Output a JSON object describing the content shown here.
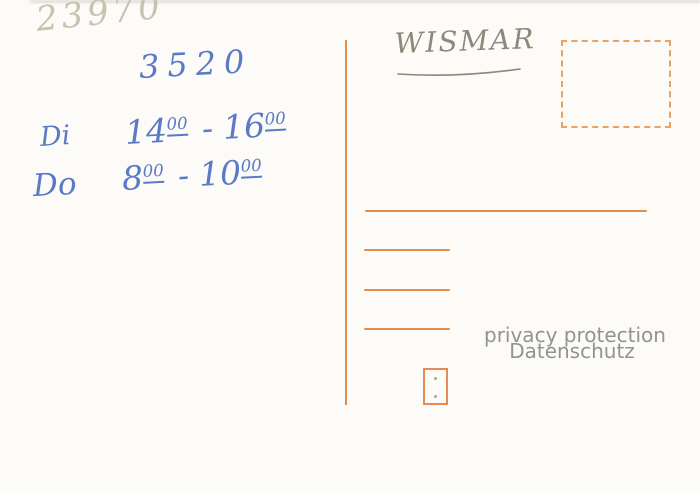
{
  "colors": {
    "background": "#fcfbf7",
    "postcard_print_orange": "#e28d49",
    "stamp_dash_orange": "#e9a263",
    "ballpoint_blue": "#5a7ac7",
    "pencil_light": "#c8c2b1",
    "pencil_dark": "#8c887a",
    "watermark_gray": "#939393"
  },
  "handwriting": {
    "postal_code_pencil": "23970",
    "code_blue": "3520",
    "city_pencil": "WISMAR",
    "schedule": [
      {
        "day": "Di",
        "from_hour": "14",
        "from_min": "00",
        "separator": "-",
        "to_hour": "16",
        "to_min": "00"
      },
      {
        "day": "Do",
        "from_hour": "8",
        "from_min": "00",
        "separator": "-",
        "to_hour": "10",
        "to_min": "00"
      }
    ]
  },
  "watermark": {
    "line1": "privacy protection",
    "line2": "Datenschutz"
  }
}
